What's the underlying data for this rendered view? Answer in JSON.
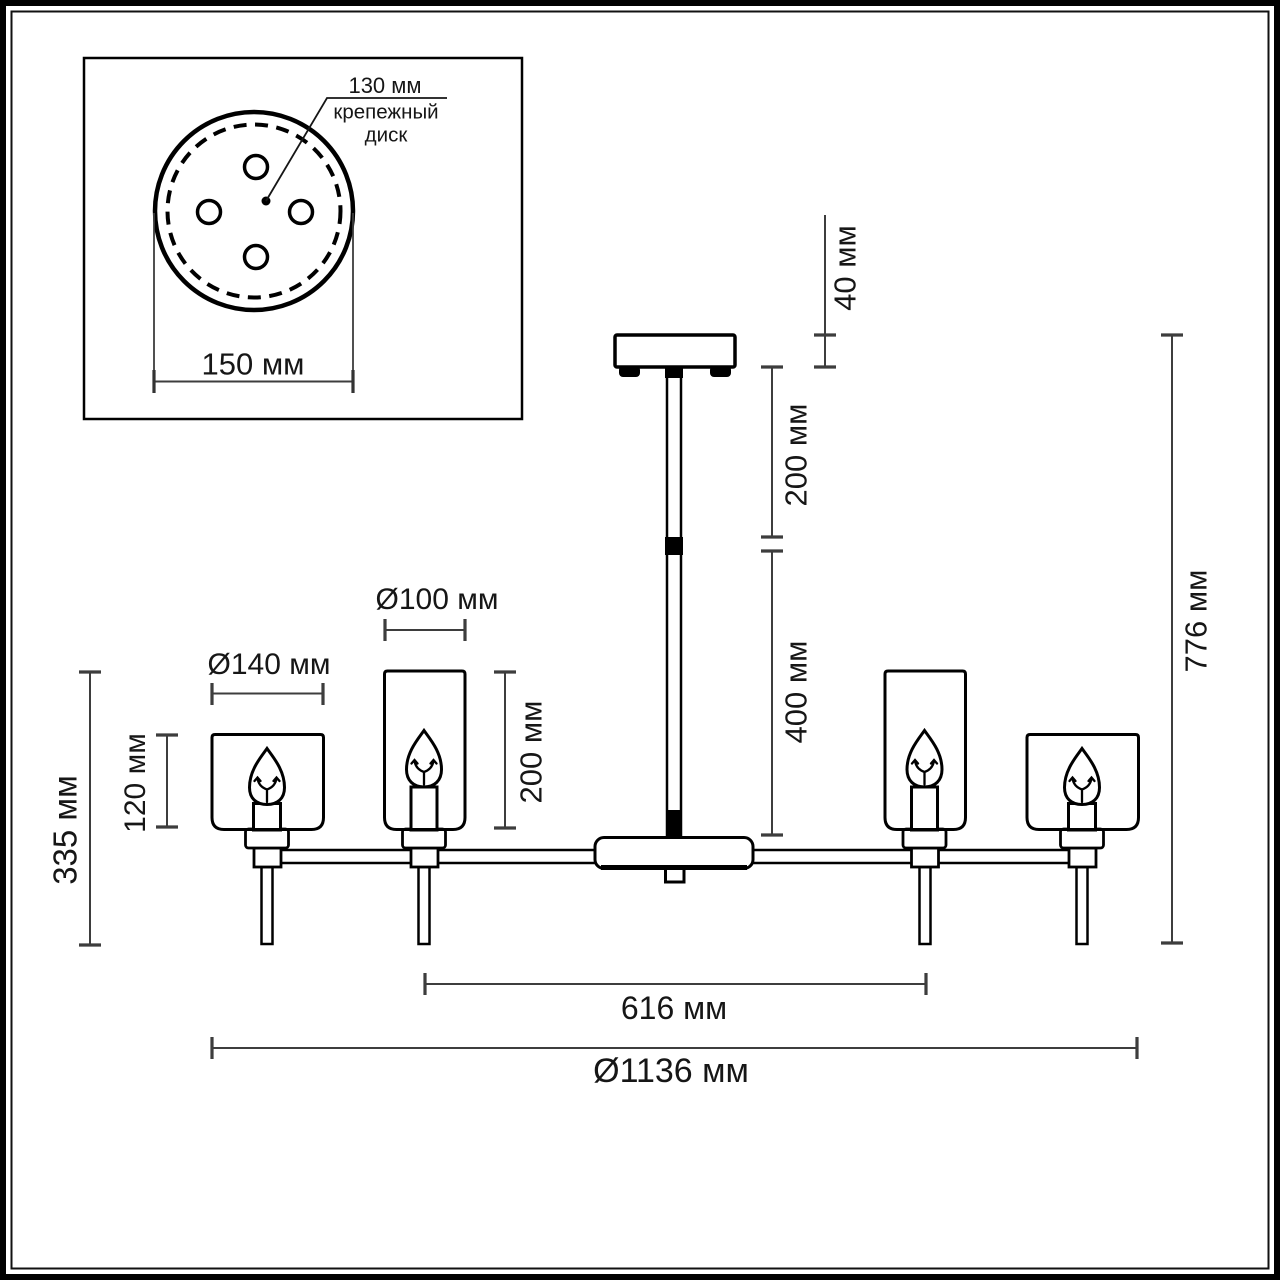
{
  "title": "chandelier-dimension-drawing",
  "colors": {
    "background": "#ffffff",
    "outline": "#000000",
    "dimension_line": "#3d3d3d",
    "text": "#161616"
  },
  "inset": {
    "disk_diameter_label": "130 мм",
    "disk_name_line1": "крепежный",
    "disk_name_line2": "диск",
    "plate_width_label": "150 мм"
  },
  "dimensions": {
    "canopy_height": "40 мм",
    "upper_rod": "200 мм",
    "lower_rod": "400 мм",
    "total_height": "776 мм",
    "shade_large_diameter": "Ø140 мм",
    "shade_small_diameter": "Ø100 мм",
    "shade_tall_height": "200 мм",
    "shade_short_height": "120 мм",
    "lamp_drop_height": "335 мм",
    "inner_arm_span": "616 мм",
    "total_diameter": "Ø1136 мм"
  }
}
